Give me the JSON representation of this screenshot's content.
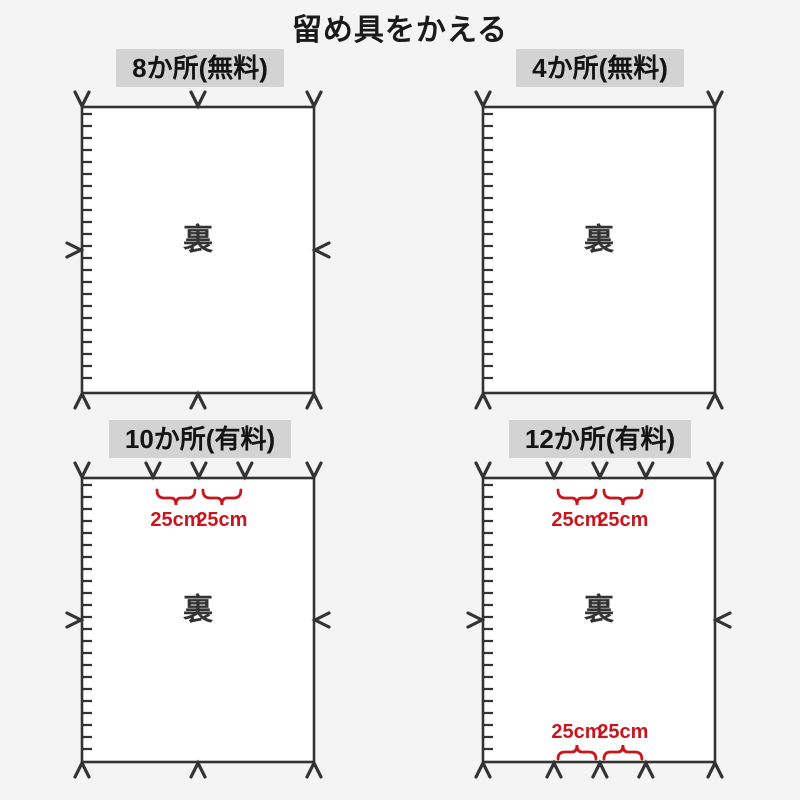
{
  "title": "留め具をかえる",
  "colors": {
    "line": "#333333",
    "red": "#c8161e",
    "header_bg": "#d3d3d3",
    "page_bg": "#f4f4f4",
    "panel_fill": "#ffffff"
  },
  "panels": [
    {
      "key": "spots-8-free",
      "label": "8か所(無料)",
      "center_label": "裏",
      "fasteners": {
        "top": [
          0,
          0.5,
          1
        ],
        "bottom": [
          0,
          0.5,
          1
        ],
        "left": [
          0.5
        ],
        "right": [
          0.5
        ]
      },
      "top_braces": [],
      "bottom_braces": []
    },
    {
      "key": "spots-4-free",
      "label": "4か所(無料)",
      "center_label": "裏",
      "fasteners": {
        "top": [
          0,
          1
        ],
        "bottom": [
          0,
          1
        ],
        "left": [],
        "right": []
      },
      "top_braces": [],
      "bottom_braces": []
    },
    {
      "key": "spots-10-paid",
      "label": "10か所(有料)",
      "center_label": "裏",
      "fasteners": {
        "top": [
          0,
          0.306,
          0.504,
          0.702,
          1
        ],
        "bottom": [
          0,
          0.5,
          1
        ],
        "left": [
          0.5
        ],
        "right": [
          0.5
        ]
      },
      "top_braces": [
        {
          "from": 1,
          "to": 2,
          "label": "25cm"
        },
        {
          "from": 2,
          "to": 3,
          "label": "25cm"
        }
      ],
      "bottom_braces": []
    },
    {
      "key": "spots-12-paid",
      "label": "12か所(有料)",
      "center_label": "裏",
      "fasteners": {
        "top": [
          0,
          0.306,
          0.504,
          0.702,
          1
        ],
        "bottom": [
          0,
          0.306,
          0.504,
          0.702,
          1
        ],
        "left": [
          0.5
        ],
        "right": [
          0.5
        ]
      },
      "top_braces": [
        {
          "from": 1,
          "to": 2,
          "label": "25cm"
        },
        {
          "from": 2,
          "to": 3,
          "label": "25cm"
        }
      ],
      "bottom_braces": [
        {
          "from": 1,
          "to": 2,
          "label": "25cm"
        },
        {
          "from": 2,
          "to": 3,
          "label": "25cm"
        }
      ]
    }
  ]
}
